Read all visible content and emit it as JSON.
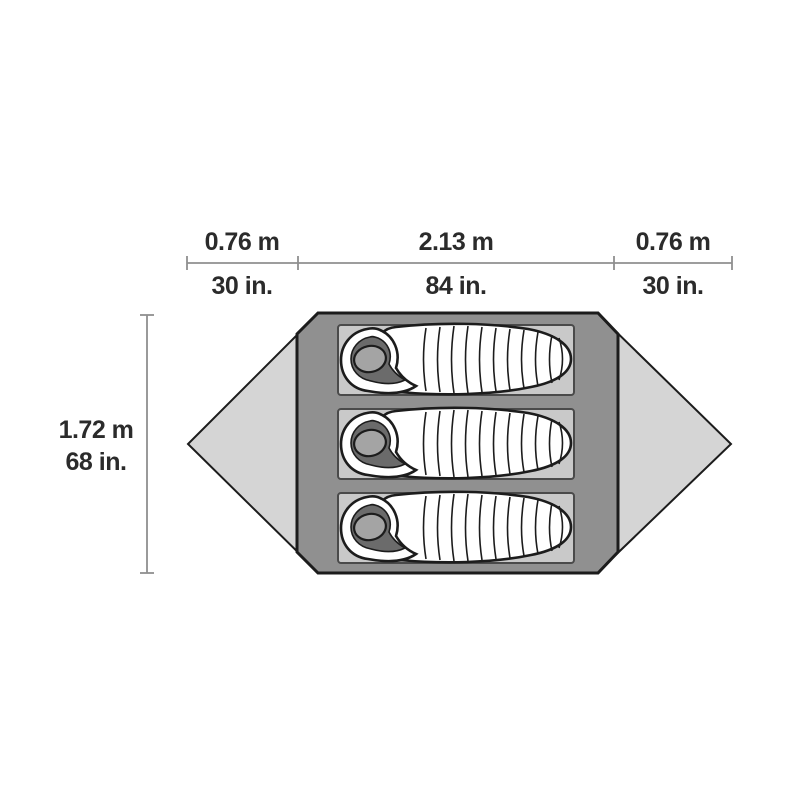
{
  "diagram": {
    "name": "tent-floor-plan",
    "description": "Top-down floor plan of a 3-person tent with two side vestibules and three sleeping bags on pads, annotated with dimensions",
    "top_dimension_segments": [
      {
        "metric": "0.76 m",
        "imperial": "30 in."
      },
      {
        "metric": "2.13 m",
        "imperial": "84 in."
      },
      {
        "metric": "0.76 m",
        "imperial": "30 in."
      }
    ],
    "side_dimension": {
      "metric": "1.72 m",
      "imperial": "68 in."
    },
    "sleeping_bag_count": 3,
    "colors": {
      "background": "#ffffff",
      "tent_body": "#909090",
      "vestibule": "#d5d5d5",
      "sleeping_pad": "#c9c9c9",
      "sleeping_bag": "#ffffff",
      "hood_opening": "#a4a4a4",
      "hood_shadow": "#6b6b6b",
      "outline": "#1c1c1c",
      "dimension_line": "#8f8f8f",
      "label_text": "#2b2b2b"
    }
  }
}
